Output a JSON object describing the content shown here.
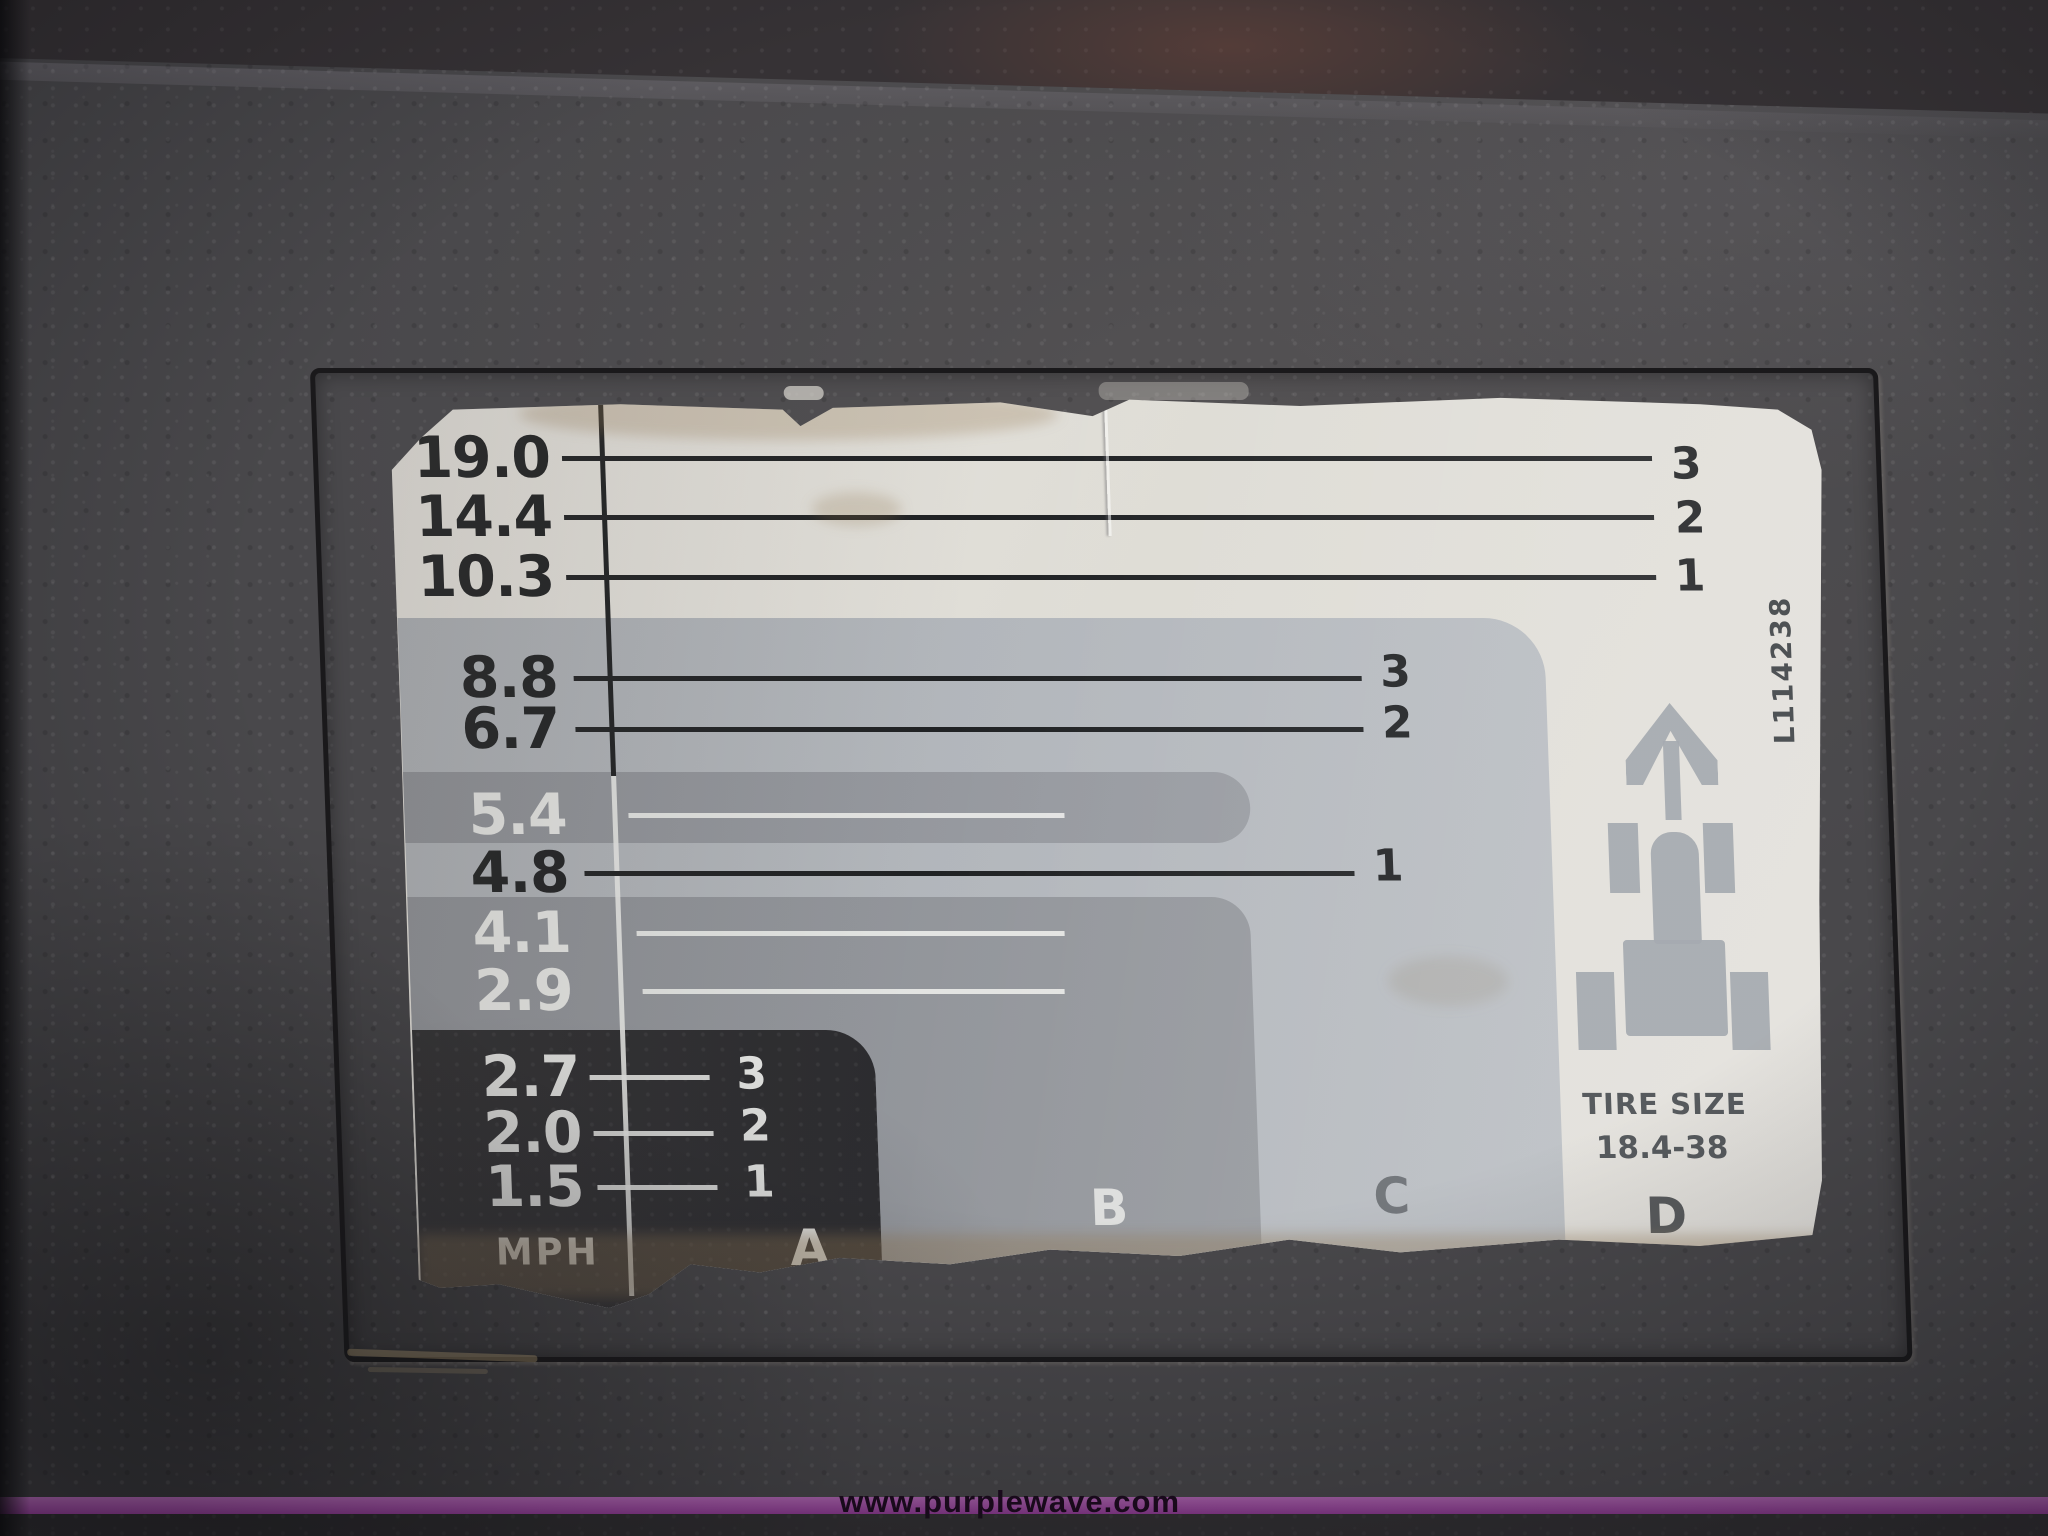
{
  "chart_data": {
    "type": "table",
    "title": "Tractor transmission ground speed chart (decal)",
    "unit": "MPH",
    "categories": [
      "D",
      "C",
      "B",
      "A"
    ],
    "series": [
      {
        "name": "D range",
        "gears": [
          3,
          2,
          1
        ],
        "values": [
          19.0,
          14.4,
          10.3
        ]
      },
      {
        "name": "C range",
        "gears": [
          3,
          2,
          1
        ],
        "values": [
          8.8,
          6.7,
          4.8
        ]
      },
      {
        "name": "B range",
        "gears": [
          3,
          2,
          1
        ],
        "values": [
          5.4,
          4.1,
          2.9
        ]
      },
      {
        "name": "A range",
        "gears": [
          3,
          2,
          1
        ],
        "values": [
          2.7,
          2.0,
          1.5
        ]
      }
    ],
    "tire_size": "18.4-38",
    "notes": "Speeds sorted top to bottom: 19.0, 14.4, 10.3, 8.8, 6.7, 5.4, 4.8, 4.1, 2.9, 2.7, 2.0, 1.5"
  },
  "rows": [
    {
      "value": "19.0",
      "gear": "3"
    },
    {
      "value": "14.4",
      "gear": "2"
    },
    {
      "value": "10.3",
      "gear": "1"
    },
    {
      "value": "8.8",
      "gear": "3"
    },
    {
      "value": "6.7",
      "gear": "2"
    },
    {
      "value": "5.4",
      "gear": ""
    },
    {
      "value": "4.8",
      "gear": "1"
    },
    {
      "value": "4.1",
      "gear": ""
    },
    {
      "value": "2.9",
      "gear": ""
    },
    {
      "value": "2.7",
      "gear": "3"
    },
    {
      "value": "2.0",
      "gear": "2"
    },
    {
      "value": "1.5",
      "gear": "1"
    }
  ],
  "decal": {
    "mph_label": "MPH",
    "range_letters": [
      "A",
      "B",
      "C",
      "D"
    ],
    "tire_size_label": "TIRE SIZE",
    "tire_size_value": "18.4-38",
    "part_number": "L114238",
    "tractor_icon": "tractor-top-view-with-up-arrow"
  },
  "colors": {
    "decal_white": "#e3e1dc",
    "range_c_gray": "#b3b7bc",
    "range_b_gray": "#92959b",
    "range_a_black": "#2c2c2f",
    "ink_dark": "#202224",
    "ink_light": "#e5e6e4",
    "icon_gray": "#9ba1a7",
    "panel_charcoal": "#49484b",
    "watermark_purple": "#a14fa6"
  },
  "watermark": {
    "text": "www.purplewave.com"
  }
}
